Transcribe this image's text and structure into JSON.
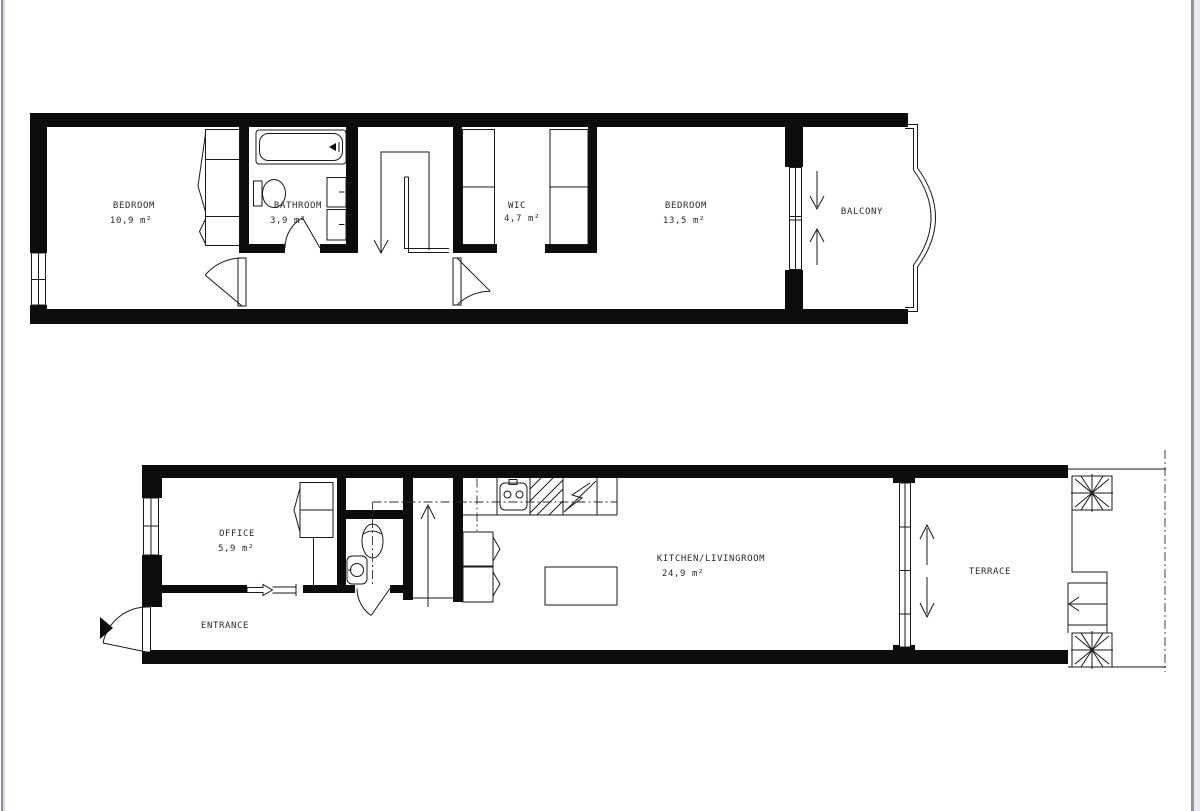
{
  "colors": {
    "wall": "#0c0c0c",
    "line": "#1a1a1a",
    "text": "#2b2b2b",
    "page_edge": "#8f8f97",
    "background": "#ffffff"
  },
  "floors": {
    "upper": {
      "rooms": {
        "bedroom1": {
          "name": "BEDROOM",
          "area": "10,9 m²"
        },
        "bathroom": {
          "name": "BATHROOM",
          "area": "3,9 m²"
        },
        "wic": {
          "name": "WIC",
          "area": "4,7 m²"
        },
        "bedroom2": {
          "name": "BEDROOM",
          "area": "13,5 m²"
        },
        "balcony": {
          "name": "BALCONY"
        }
      }
    },
    "lower": {
      "rooms": {
        "office": {
          "name": "OFFICE",
          "area": "5,9 m²"
        },
        "entrance": {
          "name": "ENTRANCE"
        },
        "kitchen_livingroom": {
          "name": "KITCHEN/LIVINGROOM",
          "area": "24,9 m²"
        },
        "terrace": {
          "name": "TERRACE"
        }
      }
    }
  }
}
